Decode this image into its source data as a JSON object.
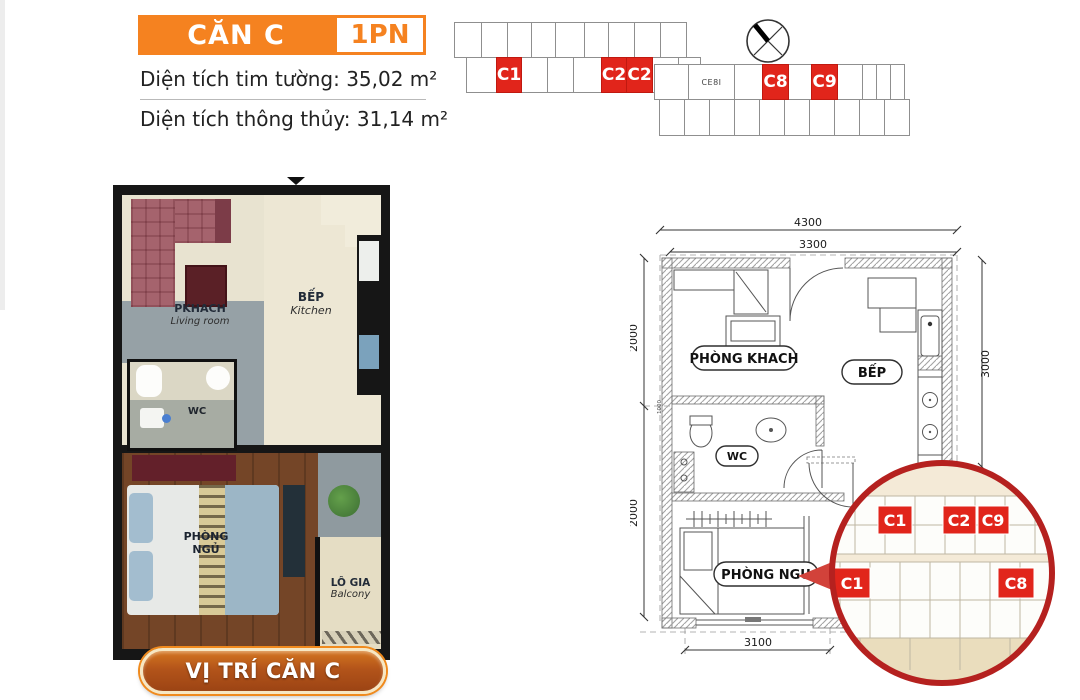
{
  "colors": {
    "accent_orange": "#F58220",
    "marker_red": "#E1251B",
    "magnifier_border_red": "#B5211F",
    "button_face": "#B3541A"
  },
  "header": {
    "unit_name": "CĂN C",
    "badge": "1PN",
    "areas": [
      {
        "label": "Diện tích tim tường:",
        "value": "35,02 m²"
      },
      {
        "label": "Diện tích thông thủy:",
        "value": "31,14 m²"
      }
    ]
  },
  "site_plan": {
    "markers": [
      "C1",
      "C2",
      "C2",
      "C8",
      "C9"
    ],
    "small_cell_label": "CE8I"
  },
  "plan3d": {
    "living_vi": "PKHACH",
    "living_en": "Living room",
    "kitchen_vi": "BẾP",
    "kitchen_en": "Kitchen",
    "wc": "WC",
    "bedroom_line1": "PHÒNG",
    "bedroom_line2": "NGỦ",
    "balcony_vi": "LÔ GIA",
    "balcony_en": "Balcony"
  },
  "location_button": {
    "label": "VỊ TRÍ CĂN C"
  },
  "plan2d": {
    "dims": {
      "top_outer": "4300",
      "top_inner": "3300",
      "left_upper": "2000",
      "left_lower": "2000",
      "left_small": "1000",
      "right": "3000",
      "bottom": "3100"
    },
    "rooms": {
      "living": "PHÒNG KHACH",
      "kitchen": "BẾP",
      "wc": "WC",
      "bedroom": "PHÒNG NGU"
    }
  },
  "magnifier": {
    "row1": [
      "C1",
      "C2",
      "C9"
    ],
    "row2": [
      "C1",
      "C8"
    ]
  }
}
